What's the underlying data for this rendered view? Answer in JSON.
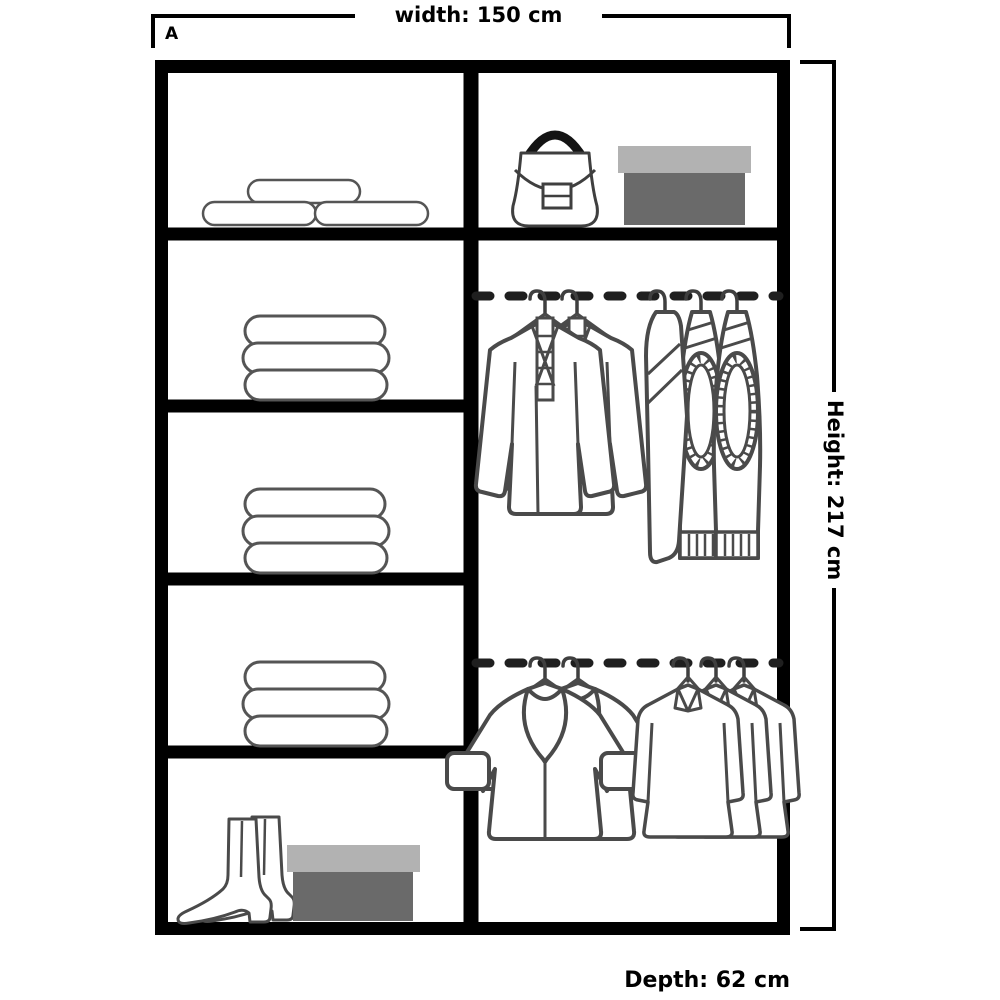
{
  "diagram": {
    "variant_label": "A",
    "width_label": "width: 150 cm",
    "height_label": "Height: 217 cm",
    "depth_label": "Depth: 62 cm"
  },
  "wardrobe": {
    "left_column": {
      "sections": [
        {
          "icon": "rolled-bedding-icon",
          "contents": "three rolled items on shelf"
        },
        {
          "icon": "folded-clothes-stack-icon",
          "contents": "stack of three folded items"
        },
        {
          "icon": "folded-clothes-stack-icon",
          "contents": "stack of three folded items"
        },
        {
          "icon": "folded-clothes-stack-icon",
          "contents": "stack of three folded items"
        },
        {
          "icon": "boots-and-shoe-box-icon",
          "contents": "pair of boots and shoe box"
        }
      ]
    },
    "right_column": {
      "top_shelf": {
        "icons": [
          "handbag-icon",
          "shoe-box-icon"
        ],
        "contents": "handbag and shoe box"
      },
      "rails": [
        {
          "icon": "hanging-rail",
          "contents": "two jackets and three trousers on hangers"
        },
        {
          "icon": "hanging-rail",
          "contents": "two coats and three shirts on hangers"
        }
      ]
    }
  },
  "colors": {
    "frame": "#000000",
    "item_outline": "#4a4a4a",
    "rail_dash": "#1f1f1f",
    "box_lid": "#b2b2b2",
    "box_body": "#6a6a6a",
    "handbag_handle": "#141414"
  }
}
